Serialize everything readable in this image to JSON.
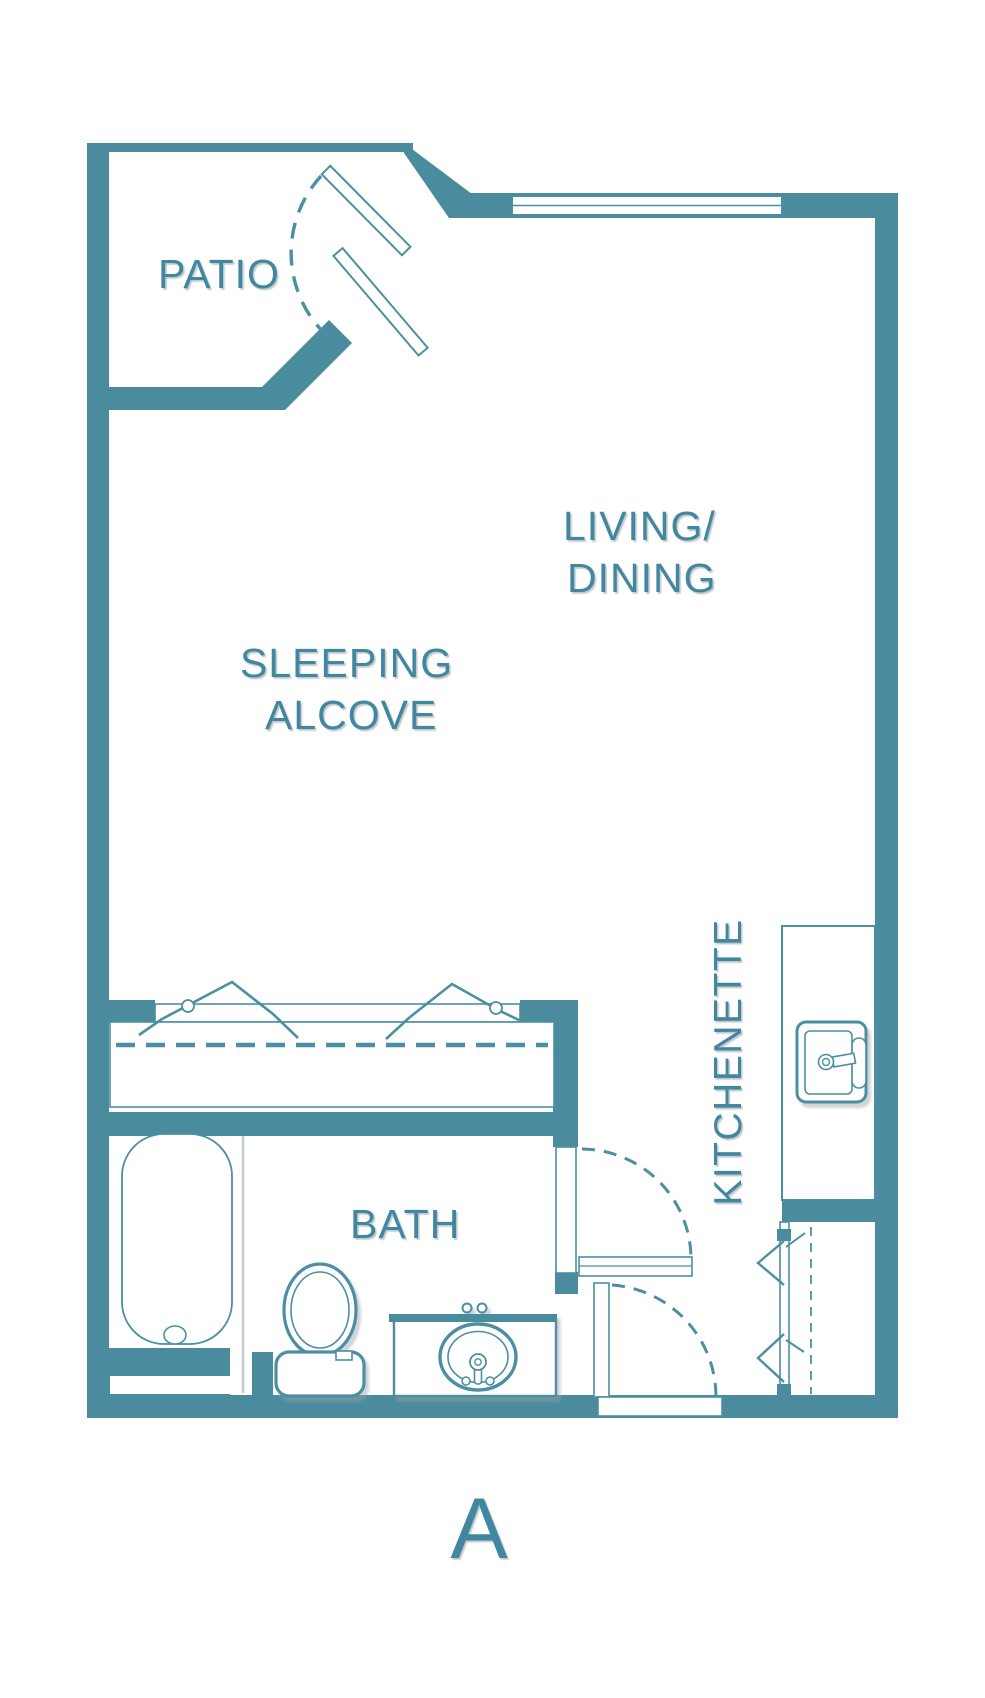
{
  "meta": {
    "title": "Studio floor plan",
    "unit_label": "A"
  },
  "palette": {
    "wall": "#4A8C9E",
    "line": "#4B8FA2",
    "text": "#3F87A2",
    "background": "#FFFFFF",
    "shadow": "#9AA0A3",
    "tub_edge_shadow": "#C4C9CC"
  },
  "labels": {
    "patio": "PATIO",
    "living_dining": [
      "LIVING/",
      "DINING"
    ],
    "sleeping_alcove": [
      "SLEEPING",
      "ALCOVE"
    ],
    "kitchenette": "KITCHENETTE",
    "bath": "BATH",
    "unit": "A"
  },
  "fixtures": [
    "patio-sliding-door",
    "window",
    "alcove-bifold-closet",
    "wardrobe",
    "kitchenette-counter",
    "kitchen-sink",
    "bathtub",
    "toilet",
    "vanity-sink",
    "bath-door",
    "entry-door",
    "entry-closet-bifold"
  ]
}
